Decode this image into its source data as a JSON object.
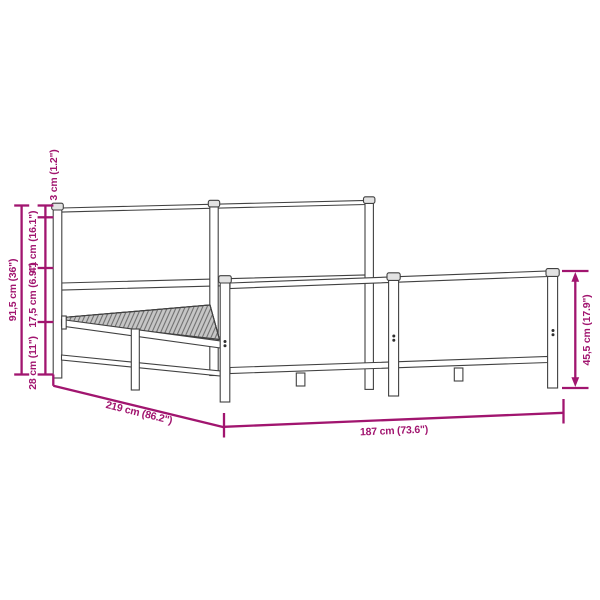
{
  "page": {
    "background": "#ffffff",
    "description": "Technical dimension diagram of a metal bed frame with headboard and footboard"
  },
  "style": {
    "accent_color": "#A1156F",
    "line_color": "#414141",
    "slat_fill": "#c6c6c6"
  },
  "dimensions": {
    "total_height_label": "91,5 cm (36\")",
    "post_cap_label": "3 cm (1.2\")",
    "headboard_panel_label": "41 cm (16.1\")",
    "slat_to_rail_label": "17,5 cm (6.9\")",
    "under_bed_clearance_label": "28 cm (11\")",
    "bed_length_label": "219 cm (86.2\")",
    "bed_width_label": "187 cm (73.6\")",
    "footboard_height_label": "45,5 cm (17.9\")"
  }
}
